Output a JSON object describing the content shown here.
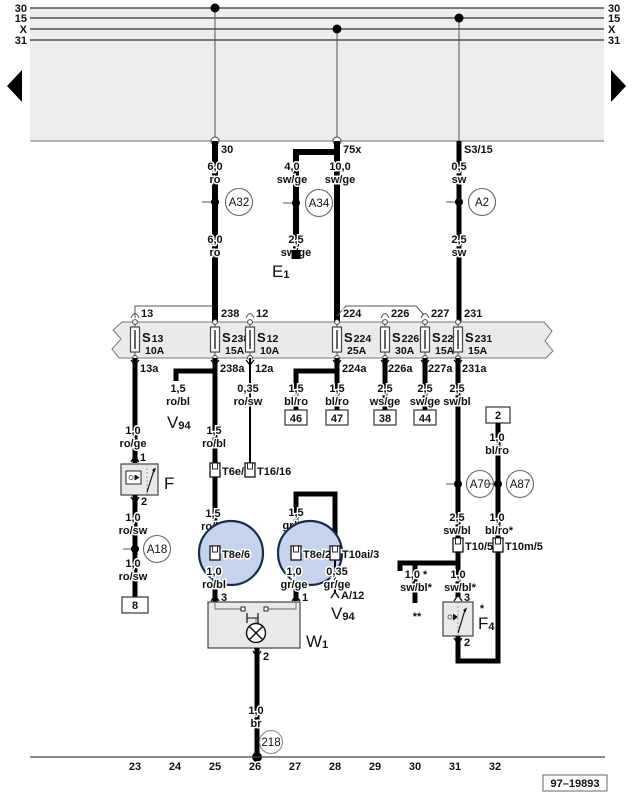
{
  "bus": {
    "left": [
      "30",
      "15",
      "X",
      "31"
    ],
    "right": [
      "30",
      "15",
      "X",
      "31"
    ],
    "taps": [
      "30",
      "75x",
      "S3/15"
    ]
  },
  "feeds": {
    "a": {
      "w1s": "6,0",
      "w1c": "ro",
      "conn": "A32",
      "w2s": "6,0",
      "w2c": "ro"
    },
    "b": {
      "mains": "10,0",
      "mainc": "sw/ge",
      "brs": "4,0",
      "brc": "sw/ge",
      "conn": "A34",
      "br2s": "2,5",
      "br2c": "sw/ge",
      "dest": "E",
      "dest_sub": "1"
    },
    "c": {
      "w1s": "0,5",
      "w1c": "sw",
      "conn": "A2",
      "w2s": "2,5",
      "w2c": "sw"
    }
  },
  "fuses": [
    {
      "pre": "13",
      "s": "S",
      "n": "13",
      "amp": "10A",
      "post": "13a"
    },
    {
      "pre": "238",
      "s": "S",
      "n": "238",
      "amp": "15A",
      "post": "238a"
    },
    {
      "pre": "12",
      "s": "S",
      "n": "12",
      "amp": "10A",
      "post": "12a"
    },
    {
      "pre": "224",
      "s": "S",
      "n": "224",
      "amp": "25A",
      "post": "224a"
    },
    {
      "pre": "226",
      "s": "S",
      "n": "226",
      "amp": "30A",
      "post": "226a"
    },
    {
      "pre": "227",
      "s": "S",
      "n": "227",
      "amp": "15A",
      "post": "227a"
    },
    {
      "pre": "231",
      "s": "S",
      "n": "231",
      "amp": "15A",
      "post": "231a"
    }
  ],
  "c13a": {
    "w1s": "1,0",
    "w1c": "ro/ge",
    "pin1": "1",
    "comp": "F",
    "pin2": "2",
    "w2s": "1,0",
    "w2c": "ro/sw",
    "conn": "A18",
    "w3s": "1,0",
    "w3c": "ro/sw",
    "dest": "8"
  },
  "c238a": {
    "sps": "1,5",
    "spc": "ro/bl",
    "spd": "V",
    "spdsub": "94",
    "w1s": "1,5",
    "w1c": "ro/bl",
    "t1": "T6e/5",
    "w2s": "1,5",
    "w2c": "ro/bl",
    "t2": "T8e/6",
    "w3s": "1,0",
    "w3c": "ro/bl",
    "pin": "3"
  },
  "c12a": {
    "ws": "0,35",
    "wc": "ro/sw",
    "t": "T16/16"
  },
  "c224a": {
    "ls": "1,5",
    "lc": "bl/ro",
    "ld": "46",
    "rs": "1,5",
    "rc": "bl/ro",
    "rd": "47"
  },
  "c226a": {
    "ws": "2,5",
    "wc": "ws/ge",
    "d": "38"
  },
  "c227a": {
    "ws": "2,5",
    "wc": "sw/ge",
    "d": "44"
  },
  "c231a": {
    "w1s": "2,5",
    "w1c": "sw/bl",
    "conn": "A70",
    "w2s": "2,5",
    "w2c": "sw/bl",
    "t": "T10/5",
    "sps": "1,0 *",
    "spc": "sw/bl*",
    "spd": "**",
    "w3s": "1,0",
    "w3c": "sw/bl*",
    "pin1": "3",
    "comp": "F",
    "compsub": "4",
    "compstar": "*",
    "pin2": "2"
  },
  "c2": {
    "src": "2",
    "w1s": "1,0",
    "w1c": "bl/ro",
    "conn": "A87",
    "w2s": "1,0",
    "w2c": "bl/ro*",
    "t": "T10m/5"
  },
  "lamp": {
    "brs": "1,5",
    "brc": "gr/ge",
    "tl": "T8e/2",
    "tr": "T10ai/3",
    "lws": "1,0",
    "lwc": "gr/ge",
    "lpin": "1",
    "rws": "0,35",
    "rwc": "gr/ge",
    "rpin": "A/12",
    "rd": "V",
    "rdsub": "94",
    "comp": "W",
    "compsub": "1",
    "pout": "2",
    "os": "1,0",
    "oc": "br",
    "gnd": "218"
  },
  "tracks": [
    "23",
    "24",
    "25",
    "26",
    "27",
    "28",
    "29",
    "30",
    "31",
    "32"
  ],
  "footer": {
    "num": "97–19893"
  }
}
